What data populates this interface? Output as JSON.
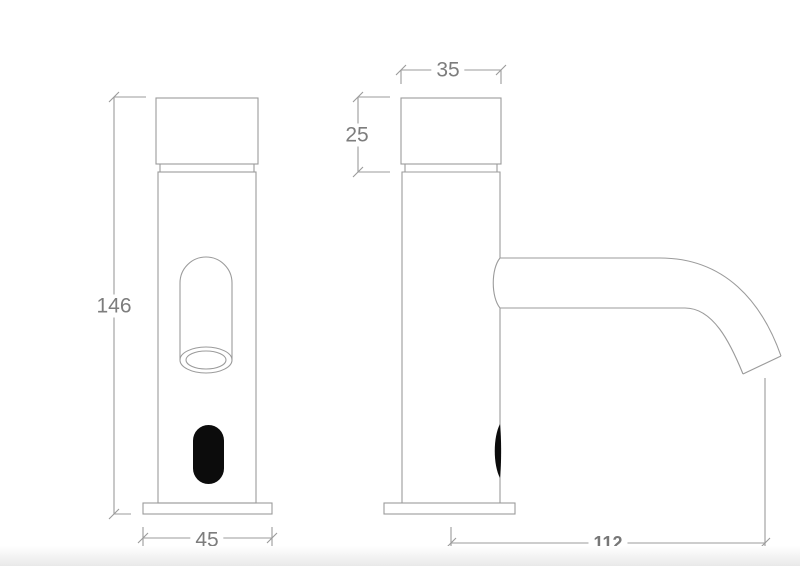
{
  "page": {
    "background": "#ffffff",
    "line_color": "#9b9b9b",
    "text_color": "#7d7d7d",
    "sensor_fill": "#0c0c0c"
  },
  "drawing": {
    "title": "Sensor faucet two-view dimensional drawing",
    "front_view": {
      "name": "front-view",
      "height_dim": "146",
      "base_width_dim": "45"
    },
    "side_view": {
      "name": "side-view",
      "cap_width_dim": "35",
      "cap_height_dim": "25",
      "spout_reach_dim": "112"
    }
  }
}
